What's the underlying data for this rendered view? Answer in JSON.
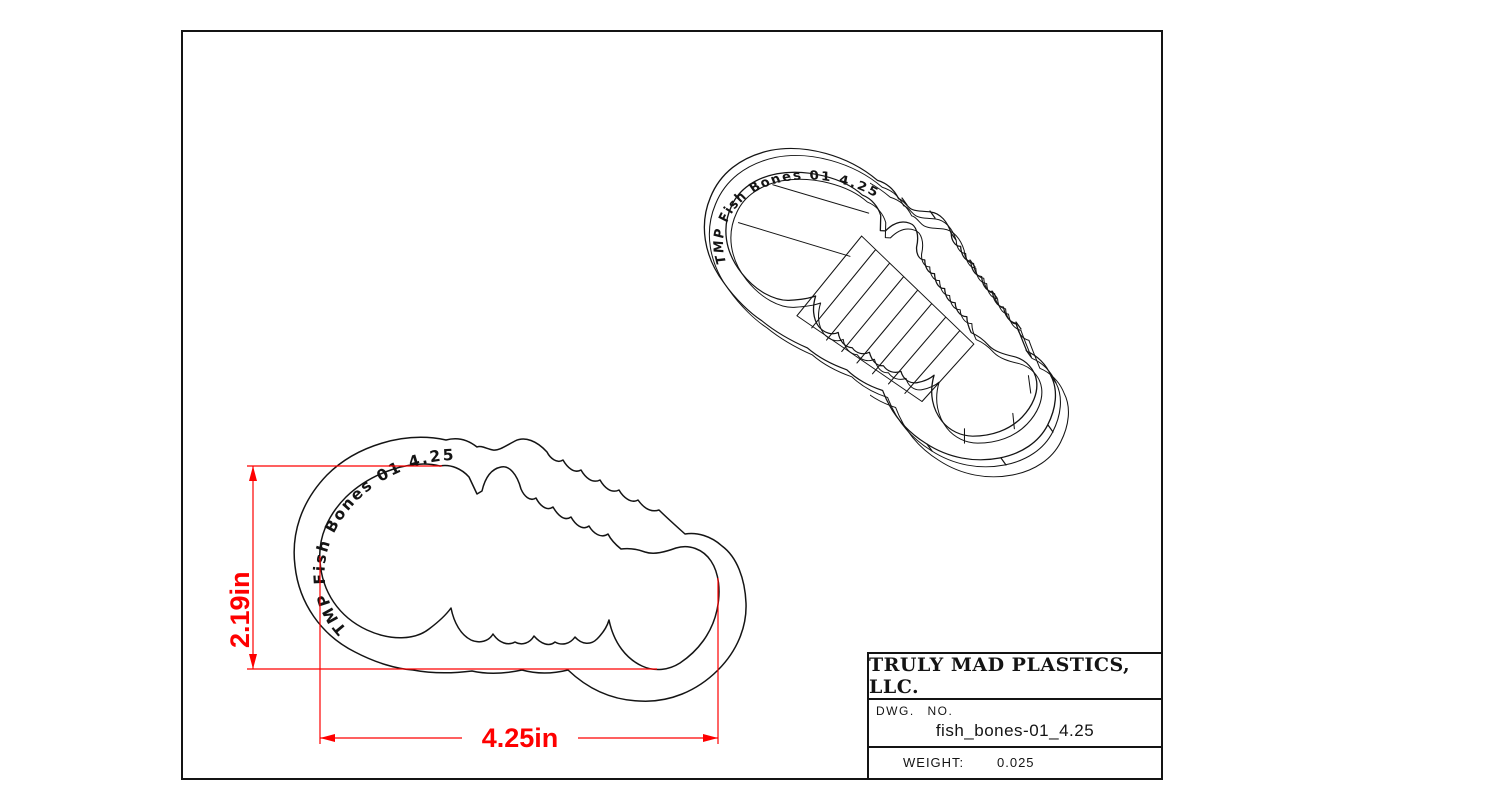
{
  "sheet": {
    "background": "#ffffff",
    "ink_color": "#141414",
    "dimension_color": "#fe0000"
  },
  "plan_view": {
    "embossed_text": "TMP Fish Bones 01 4.25",
    "height_dimension": "2.19in",
    "width_dimension": "4.25in"
  },
  "iso_view": {
    "embossed_text": "TMP Fish Bones 01 4.25"
  },
  "title_block": {
    "company": "TRULY MAD PLASTICS, LLC.",
    "dwg_label": "DWG. NO.",
    "dwg_number": "fish_bones-01_4.25",
    "weight_label": "WEIGHT:",
    "weight_value": "0.025"
  }
}
